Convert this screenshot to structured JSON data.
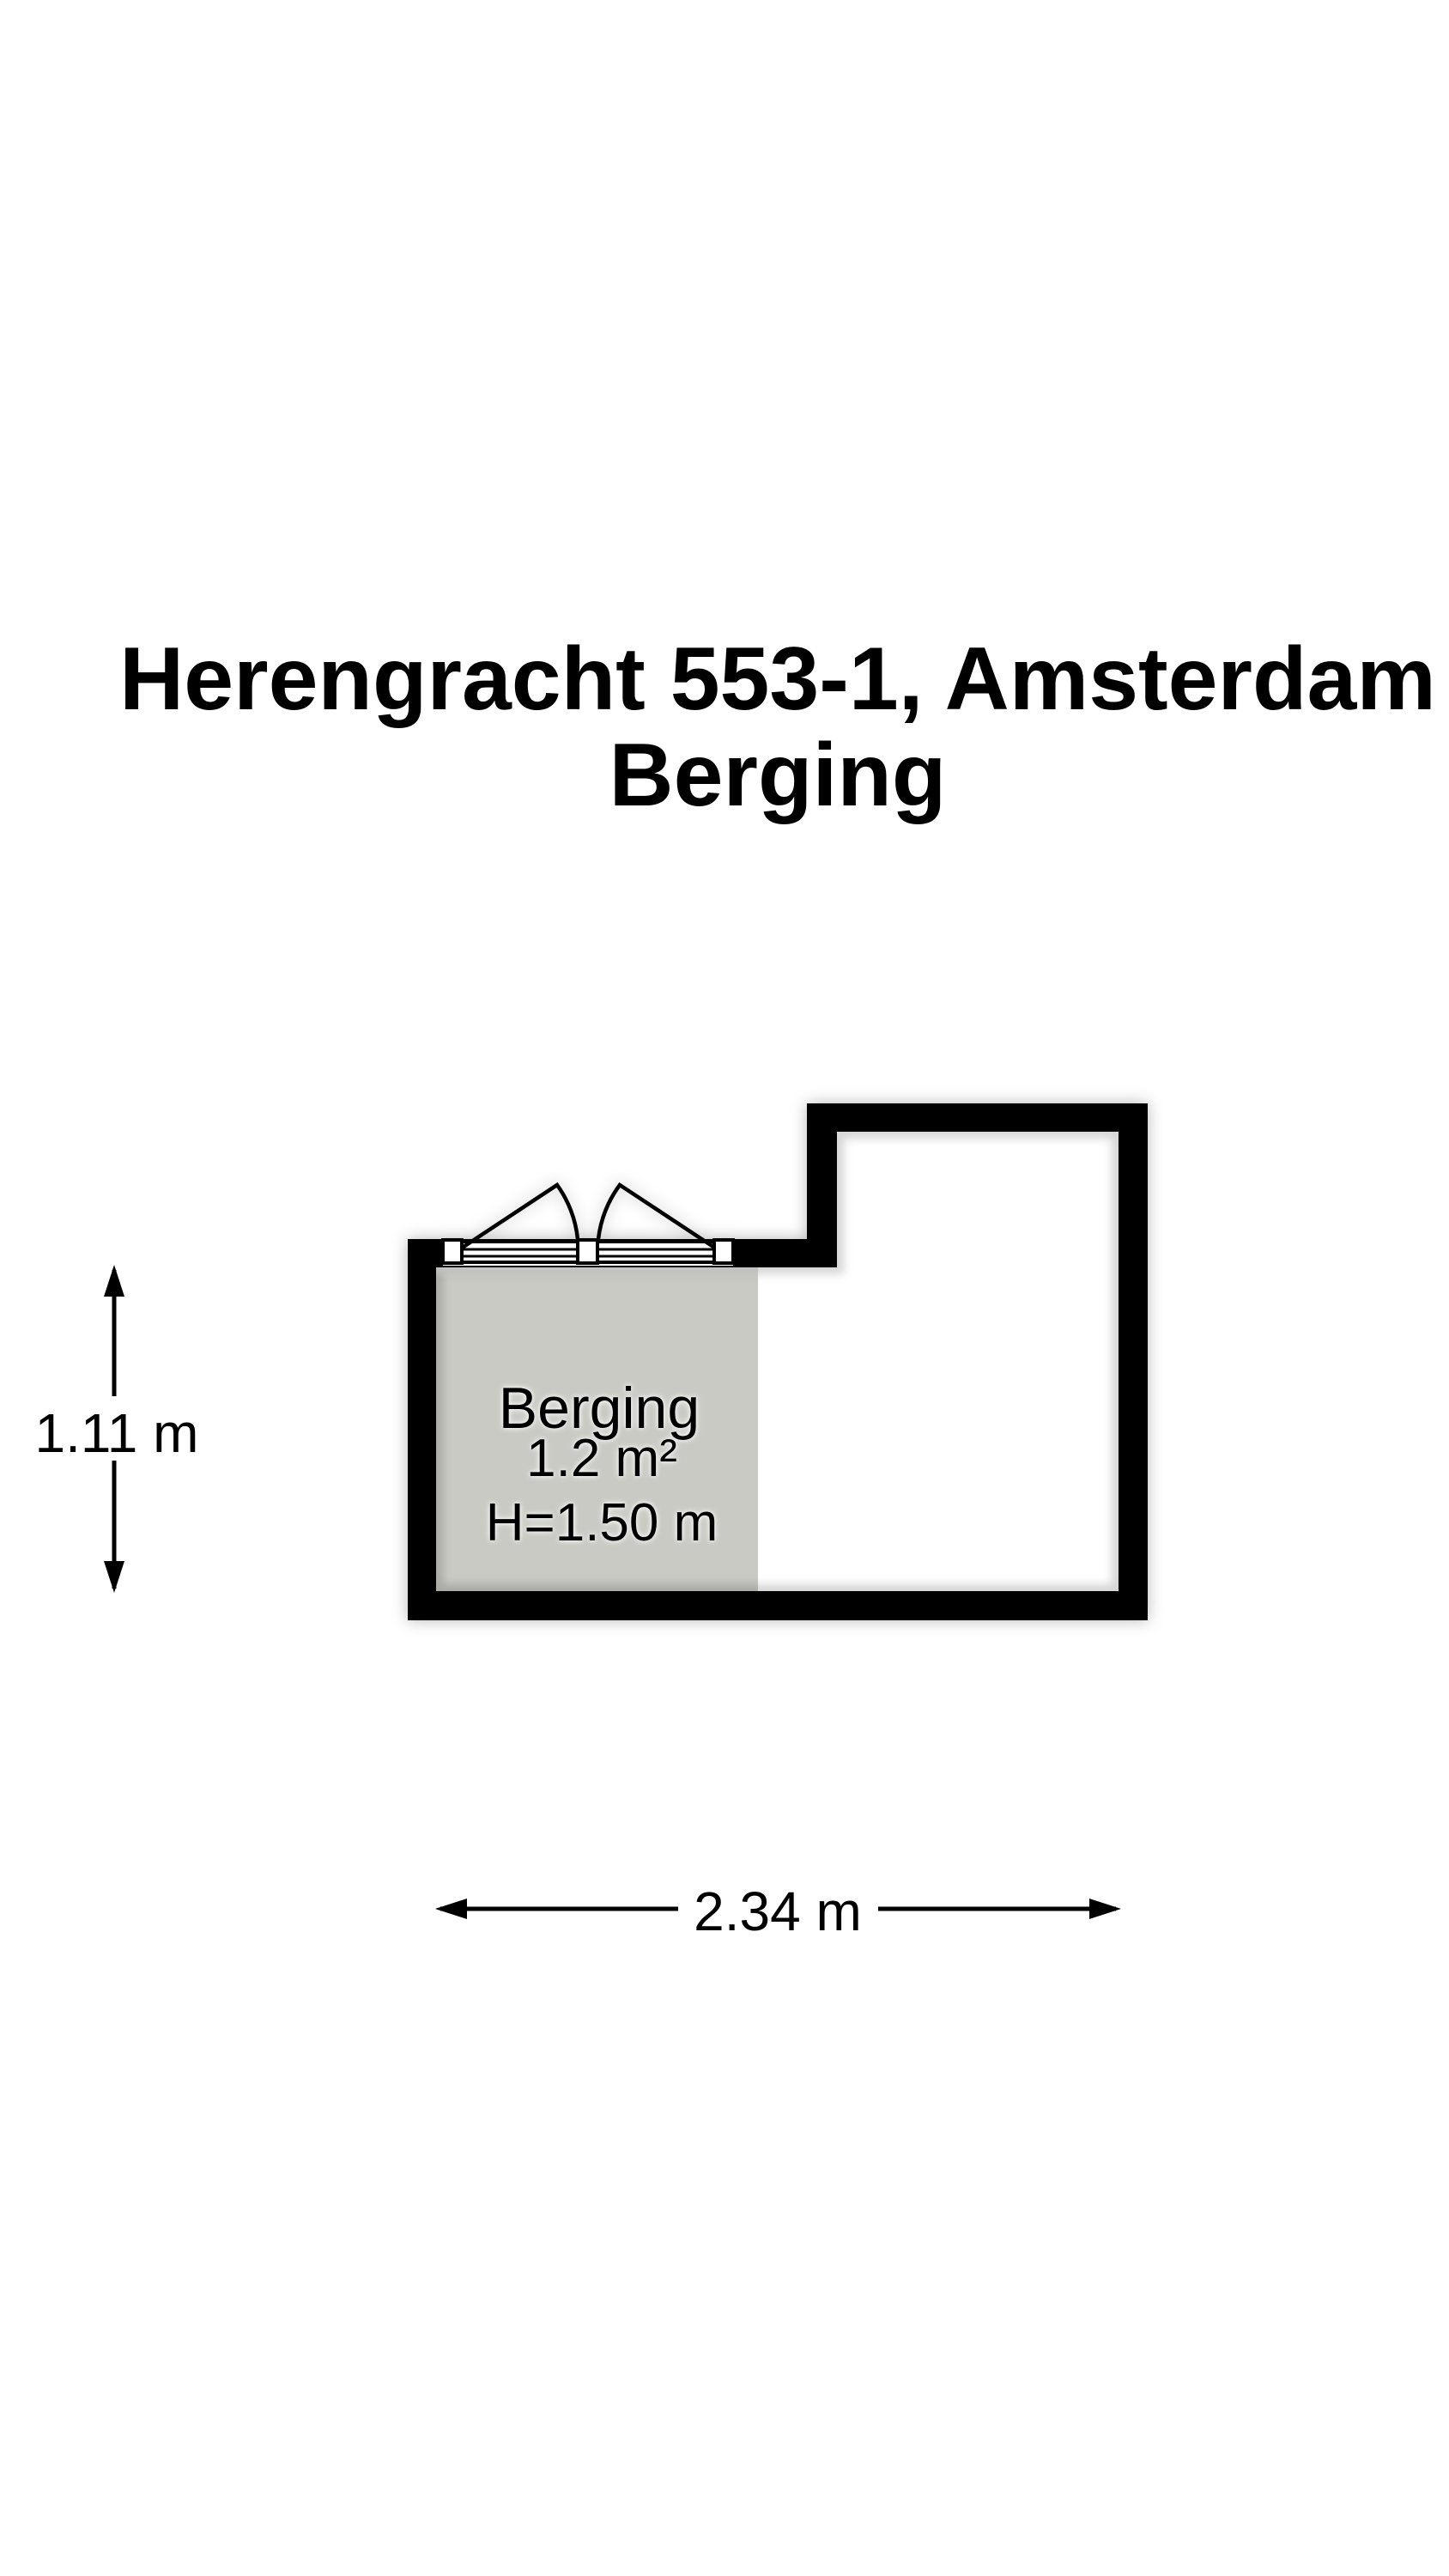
{
  "page": {
    "background_color": "#ffffff"
  },
  "title": {
    "line1": "Herengracht 553-1, Amsterdam",
    "line2": "Berging"
  },
  "floorplan": {
    "room": {
      "name": "Berging",
      "area_label": "1.2 m²",
      "ceiling_height_label": "H=1.50 m"
    },
    "dimensions": {
      "interior_height_label": "1.11 m",
      "interior_width_label": "2.34 m"
    },
    "colors": {
      "wall": "#000000",
      "room_fill": "#c9cac3",
      "interior": "#ffffff",
      "text": "#000000"
    }
  }
}
